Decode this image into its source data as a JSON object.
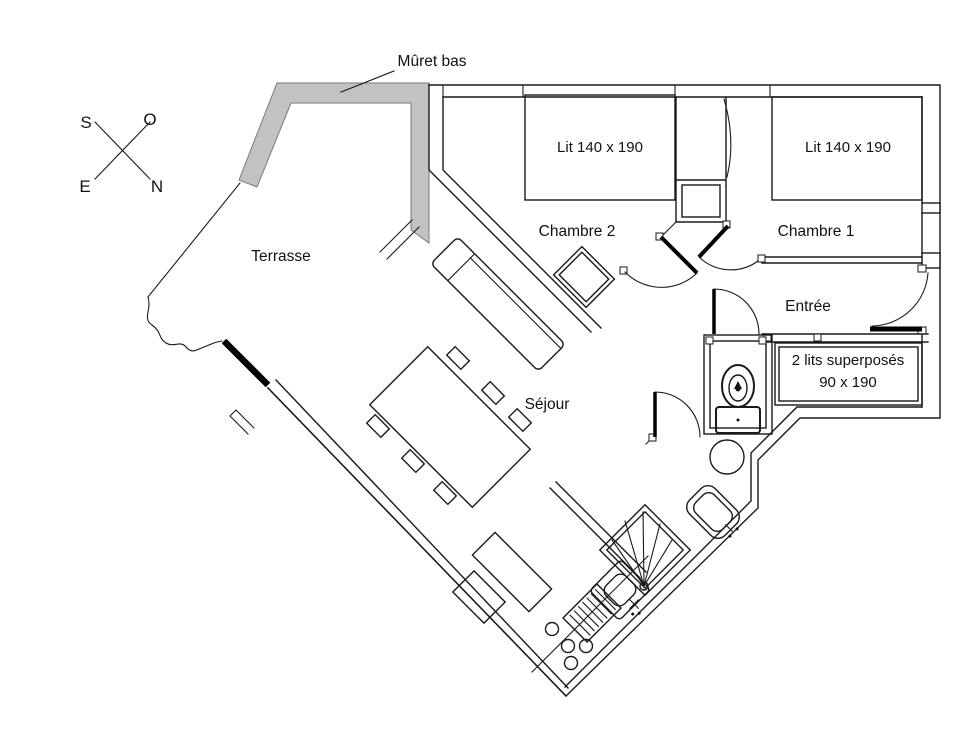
{
  "compass": {
    "s": "S",
    "o": "O",
    "e": "E",
    "n": "N"
  },
  "annotations": {
    "muret_bas": "Mûret bas"
  },
  "rooms": {
    "terrasse": "Terrasse",
    "chambre2": "Chambre 2",
    "chambre1": "Chambre 1",
    "entree": "Entrée",
    "sejour": "Séjour"
  },
  "furniture": {
    "bed_chambre2": "Lit 140 x 190",
    "bed_chambre1": "Lit 140 x 190",
    "bunk_line1": "2 lits superposés",
    "bunk_line2": "90 x 190"
  },
  "colors": {
    "wall_line": "#1a1a1a",
    "muret_fill": "#c2c2c2",
    "muret_stroke": "#7a7a7a",
    "door_leaf": "#000000",
    "background": "#ffffff",
    "text": "#111111"
  }
}
